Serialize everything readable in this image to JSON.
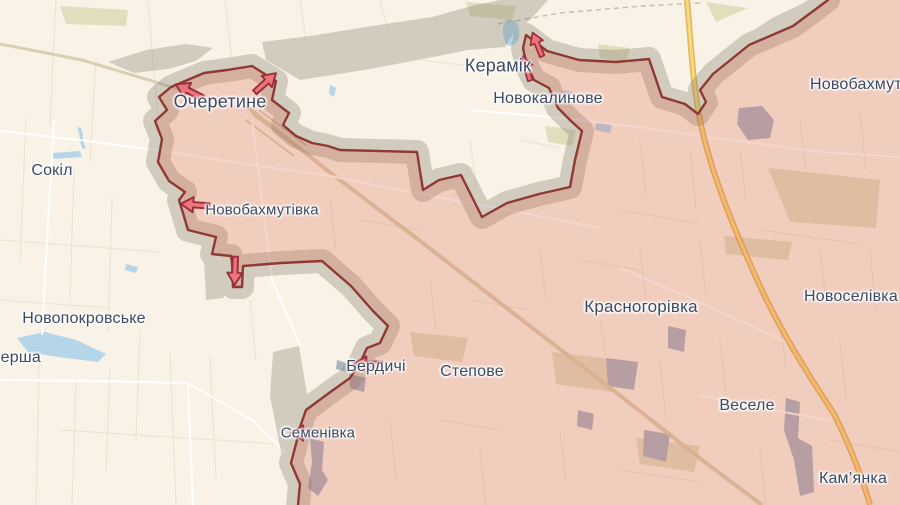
{
  "map": {
    "colors": {
      "land": "#f8f3e6",
      "field_line": "#e7e0cb",
      "water": "#b5d6e8",
      "pond_gray": "#a9b4c1",
      "road": "#ffffff",
      "track": "#d8cba6",
      "highway_fill": "#f8da7e",
      "highway_casing": "#e0a845",
      "occupied_fill": "rgba(219,98,78,0.26)",
      "frontline": "#8f3834",
      "contested_gray": "#7d7669",
      "arrow_fill": "#ed7379",
      "arrow_stroke": "#97303c",
      "label_color": "#3d4a63"
    },
    "labels": [
      {
        "id": "ocheretyne",
        "text": "Очеретине",
        "x": 220,
        "y": 103,
        "size": 18
      },
      {
        "id": "keramik",
        "text": "Керамік",
        "x": 498,
        "y": 67,
        "size": 18
      },
      {
        "id": "novokalynove",
        "text": "Новокалинове",
        "x": 548,
        "y": 100,
        "size": 16
      },
      {
        "id": "novobakhmutivka-ne",
        "text": "Новобахмутівка",
        "x": 810,
        "y": 86,
        "size": 16,
        "align": "start"
      },
      {
        "id": "sokil",
        "text": "Сокіл",
        "x": 52,
        "y": 172,
        "size": 16
      },
      {
        "id": "novobakhmutivka",
        "text": "Новобахмутівка",
        "x": 262,
        "y": 211,
        "size": 15
      },
      {
        "id": "novopokrovske",
        "text": "Новопокровське",
        "x": 84,
        "y": 320,
        "size": 16
      },
      {
        "id": "persha",
        "text": "Перша",
        "x": 15,
        "y": 359,
        "size": 16
      },
      {
        "id": "berdychi",
        "text": "Бердичі",
        "x": 376,
        "y": 368,
        "size": 16
      },
      {
        "id": "stepove",
        "text": "Степове",
        "x": 472,
        "y": 373,
        "size": 16
      },
      {
        "id": "semenivka",
        "text": "Семенівка",
        "x": 318,
        "y": 434,
        "size": 15
      },
      {
        "id": "krasnohorivka",
        "text": "Красногорівка",
        "x": 641,
        "y": 308,
        "size": 17
      },
      {
        "id": "novoselivka",
        "text": "Новоселівка",
        "x": 851,
        "y": 298,
        "size": 16
      },
      {
        "id": "vesele",
        "text": "Веселе",
        "x": 747,
        "y": 407,
        "size": 16
      },
      {
        "id": "kamianka",
        "text": "Кам’янка",
        "x": 853,
        "y": 480,
        "size": 16
      }
    ],
    "arrows": [
      {
        "id": "ocheretyne-west",
        "x": 191,
        "y": 92,
        "angle": 207,
        "scale": 1.0
      },
      {
        "id": "ocheretyne-northeast",
        "x": 264,
        "y": 84,
        "angle": 318,
        "scale": 0.95
      },
      {
        "id": "keramik-north-upper",
        "x": 538,
        "y": 46,
        "angle": 248,
        "scale": 0.85
      },
      {
        "id": "keramik-north-lower",
        "x": 527,
        "y": 70,
        "angle": 253,
        "scale": 0.85
      },
      {
        "id": "novobakhmutivka-west",
        "x": 197,
        "y": 205,
        "angle": 184,
        "scale": 0.95
      },
      {
        "id": "novobakhmutivka-south",
        "x": 235,
        "y": 269,
        "angle": 92,
        "scale": 0.95
      },
      {
        "id": "berdychi-west",
        "x": 370,
        "y": 364,
        "angle": 181,
        "scale": 0.95
      },
      {
        "id": "semenivka-west",
        "x": 307,
        "y": 433,
        "angle": 180,
        "scale": 0.95
      }
    ]
  }
}
